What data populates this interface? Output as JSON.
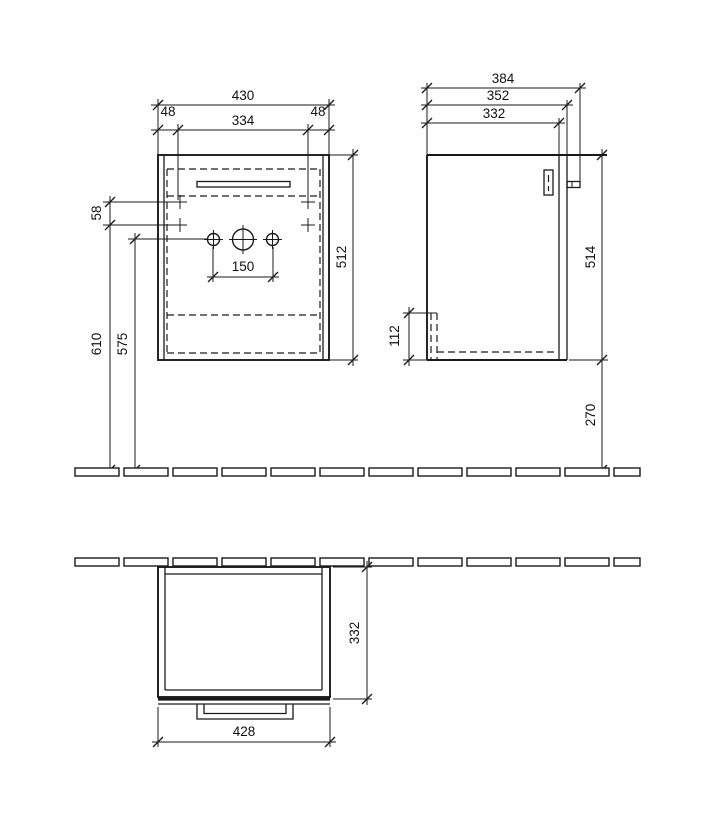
{
  "drawing": {
    "line_color": "#1a1a1a",
    "background": "#ffffff",
    "front_view": {
      "total_width": "430",
      "left_offset": "48",
      "mount_hole_width": "334",
      "right_offset": "48",
      "mount_hole_vertical_spacing": "58",
      "body_height": "512",
      "tap_hole_spacing": "150",
      "mount_height_from_floor": "610",
      "tap_hole_height_from_floor": "575"
    },
    "side_view": {
      "total_depth": "384",
      "depth_with_door": "352",
      "body_depth": "332",
      "body_height": "514",
      "rear_cutout_height": "112",
      "floor_clearance": "270"
    },
    "plan_view": {
      "body_depth": "332",
      "front_width": "428"
    }
  }
}
